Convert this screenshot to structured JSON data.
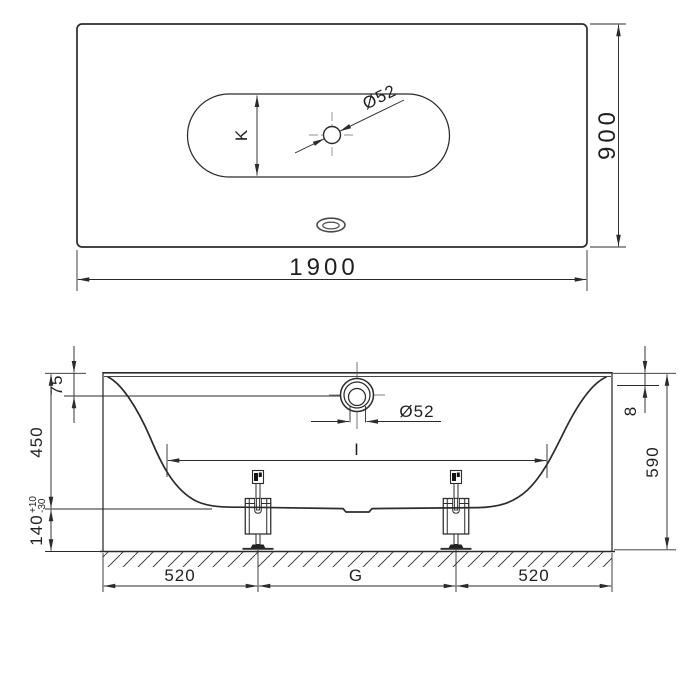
{
  "drawing": {
    "top_view": {
      "length": "1900",
      "width": "900",
      "inner_width": "K",
      "drain_diameter": "Ø52"
    },
    "side_view": {
      "rim_to_overflow": "75",
      "inner_depth": "450",
      "leg_height": "140",
      "leg_height_tol_plus": "+10",
      "leg_height_tol_minus": "-30",
      "rim_edge_height": "8",
      "overall_height": "590",
      "overflow_diameter": "Ø52",
      "inner_length": "I",
      "left_leg_offset": "520",
      "leg_distance": "G",
      "right_leg_offset": "520"
    },
    "colors": {
      "line": "#2b2b2b",
      "centerline": "#8f8f8f",
      "background": "#ffffff"
    }
  }
}
